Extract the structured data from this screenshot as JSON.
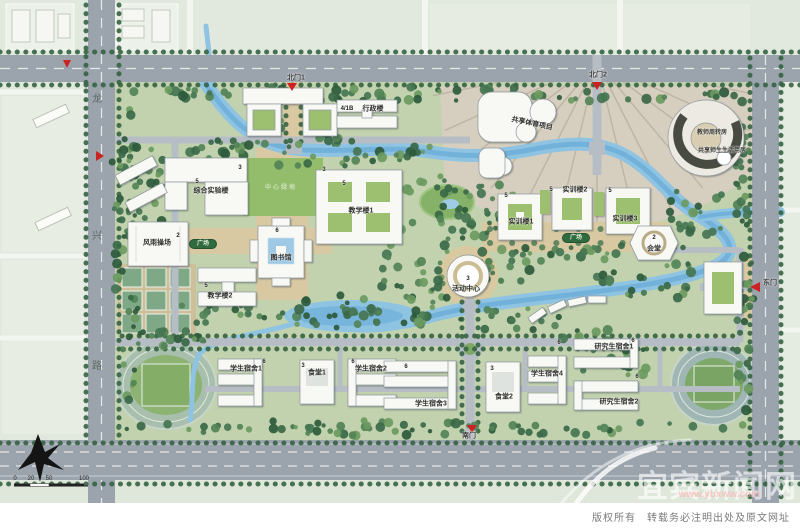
{
  "map": {
    "title_hint": "campus master plan",
    "labels": [
      {
        "t": "4/1B",
        "x": 347,
        "y": 109,
        "c": "num"
      },
      {
        "t": "行政楼",
        "x": 373,
        "y": 109,
        "c": "bld"
      },
      {
        "t": "综合实验楼",
        "x": 211,
        "y": 191,
        "c": "bld"
      },
      {
        "t": "5",
        "x": 197,
        "y": 182,
        "c": "num"
      },
      {
        "t": "3",
        "x": 240,
        "y": 168,
        "c": "num"
      },
      {
        "t": "教学楼1",
        "x": 361,
        "y": 211,
        "c": "bld"
      },
      {
        "t": "5",
        "x": 344,
        "y": 184,
        "c": "num"
      },
      {
        "t": "3",
        "x": 324,
        "y": 170,
        "c": "num"
      },
      {
        "t": "教学楼2",
        "x": 220,
        "y": 296,
        "c": "bld"
      },
      {
        "t": "5",
        "x": 206,
        "y": 286,
        "c": "num"
      },
      {
        "t": "图书馆",
        "x": 281,
        "y": 258,
        "c": "bld"
      },
      {
        "t": "6",
        "x": 277,
        "y": 231,
        "c": "num"
      },
      {
        "t": "风雨操场",
        "x": 157,
        "y": 243,
        "c": "bld"
      },
      {
        "t": "2",
        "x": 178,
        "y": 236,
        "c": "num"
      },
      {
        "t": "实训楼1",
        "x": 521,
        "y": 222,
        "c": "bld"
      },
      {
        "t": "5",
        "x": 506,
        "y": 196,
        "c": "num"
      },
      {
        "t": "实训楼2",
        "x": 575,
        "y": 190,
        "c": "bld"
      },
      {
        "t": "5",
        "x": 551,
        "y": 190,
        "c": "num"
      },
      {
        "t": "实训楼3",
        "x": 625,
        "y": 219,
        "c": "bld"
      },
      {
        "t": "5",
        "x": 610,
        "y": 191,
        "c": "num"
      },
      {
        "t": "会堂",
        "x": 654,
        "y": 249,
        "c": "bld"
      },
      {
        "t": "2",
        "x": 654,
        "y": 238,
        "c": "num"
      },
      {
        "t": "活动中心",
        "x": 466,
        "y": 289,
        "c": "bld"
      },
      {
        "t": "3",
        "x": 468,
        "y": 279,
        "c": "num"
      },
      {
        "t": "共享体育项目",
        "x": 532,
        "y": 124,
        "c": "bld",
        "r": 12
      },
      {
        "t": "教师周转房",
        "x": 712,
        "y": 133,
        "c": "tiny"
      },
      {
        "t": "共享师生生活用房",
        "x": 722,
        "y": 151,
        "c": "tiny"
      },
      {
        "t": "中心绿地",
        "x": 281,
        "y": 188,
        "c": "faint"
      },
      {
        "t": "广场",
        "x": 203,
        "y": 244,
        "c": "oval"
      },
      {
        "t": "广场",
        "x": 576,
        "y": 238,
        "c": "oval"
      },
      {
        "t": "学生宿舍1",
        "x": 246,
        "y": 369,
        "c": "bld"
      },
      {
        "t": "6",
        "x": 264,
        "y": 362,
        "c": "num"
      },
      {
        "t": "食堂1",
        "x": 317,
        "y": 373,
        "c": "bld"
      },
      {
        "t": "3",
        "x": 303,
        "y": 366,
        "c": "num"
      },
      {
        "t": "学生宿舍2",
        "x": 371,
        "y": 369,
        "c": "bld"
      },
      {
        "t": "6",
        "x": 353,
        "y": 362,
        "c": "num"
      },
      {
        "t": "学生宿舍3",
        "x": 431,
        "y": 404,
        "c": "bld"
      },
      {
        "t": "6",
        "x": 406,
        "y": 367,
        "c": "num"
      },
      {
        "t": "食堂2",
        "x": 504,
        "y": 397,
        "c": "bld"
      },
      {
        "t": "3",
        "x": 492,
        "y": 369,
        "c": "num"
      },
      {
        "t": "学生宿舍4",
        "x": 547,
        "y": 374,
        "c": "bld"
      },
      {
        "t": "6",
        "x": 559,
        "y": 343,
        "c": "num"
      },
      {
        "t": "研究生宿舍1",
        "x": 614,
        "y": 347,
        "c": "bld"
      },
      {
        "t": "6",
        "x": 633,
        "y": 341,
        "c": "num"
      },
      {
        "t": "研究生宿舍2",
        "x": 619,
        "y": 402,
        "c": "bld"
      },
      {
        "t": "6",
        "x": 637,
        "y": 377,
        "c": "num"
      },
      {
        "t": "北门1",
        "x": 296,
        "y": 78,
        "c": "gate"
      },
      {
        "t": "北门2",
        "x": 598,
        "y": 75,
        "c": "gate"
      },
      {
        "t": "东门",
        "x": 770,
        "y": 283,
        "c": "gate"
      },
      {
        "t": "南门",
        "x": 469,
        "y": 436,
        "c": "gate"
      },
      {
        "t": "龙",
        "x": 97,
        "y": 100,
        "c": "road"
      },
      {
        "t": "兴",
        "x": 97,
        "y": 237,
        "c": "road"
      },
      {
        "t": "路",
        "x": 97,
        "y": 367,
        "c": "road"
      },
      {
        "t": "0",
        "x": 15,
        "y": 479,
        "c": "sc"
      },
      {
        "t": "20",
        "x": 31,
        "y": 479,
        "c": "sc"
      },
      {
        "t": "50",
        "x": 49,
        "y": 479,
        "c": "sc"
      },
      {
        "t": "100",
        "x": 84,
        "y": 479,
        "c": "sc"
      }
    ]
  },
  "watermark": {
    "brand": "宜宾新闻网",
    "url": "www.ybxww.com"
  },
  "footer": {
    "copyright": "版权所有　转载务必注明出处及原文网址"
  },
  "colors": {
    "road": "#9ba4ad",
    "inner_road": "#b6bdc4",
    "water": "#8ec3e2",
    "water_deep": "#6caed8",
    "campus_green": "#c2d2ae",
    "forest": "#396846",
    "plaza_tan": "#d8c9a2",
    "lawn": "#93bd6a",
    "gate_marker": "#cc2222",
    "building": "#f8f8f4"
  }
}
